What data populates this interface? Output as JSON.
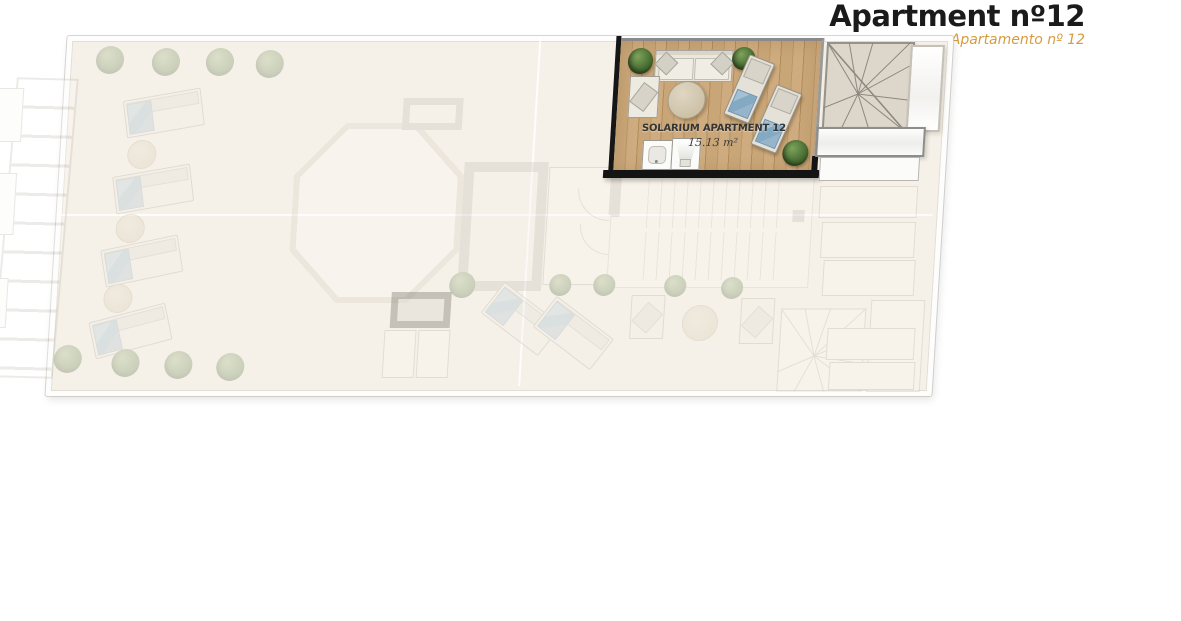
{
  "header": {
    "title": "Apartment nº12",
    "subtitle": "Apartamento nº 12"
  },
  "solarium": {
    "label": "SOLARIUM APARTMENT 12",
    "area": "15.13 m²"
  },
  "colors": {
    "title_text": "#1b1b1b",
    "subtitle_orange": "#d89b3f",
    "wood_floor": "#c8a578",
    "boundary_black": "#161616",
    "towel_blue": "#8aadc5",
    "plant_green": "#5d7f45",
    "faded_floor": "#f6f1e8",
    "wall_grey": "#c9c5bc"
  },
  "plan": {
    "highlighted_room": "solarium-apartment-12",
    "furniture_in_solarium": [
      "plant",
      "sofa",
      "armchair",
      "round-table",
      "sun-lounger",
      "sun-lounger",
      "sink",
      "shower-tray",
      "plant",
      "plant"
    ],
    "other_elements": [
      "winder-staircase",
      "elevator-shaft",
      "staircase",
      "octagonal-skylight",
      "pergola",
      "sun-loungers",
      "round-tables",
      "armchairs",
      "planters"
    ]
  }
}
